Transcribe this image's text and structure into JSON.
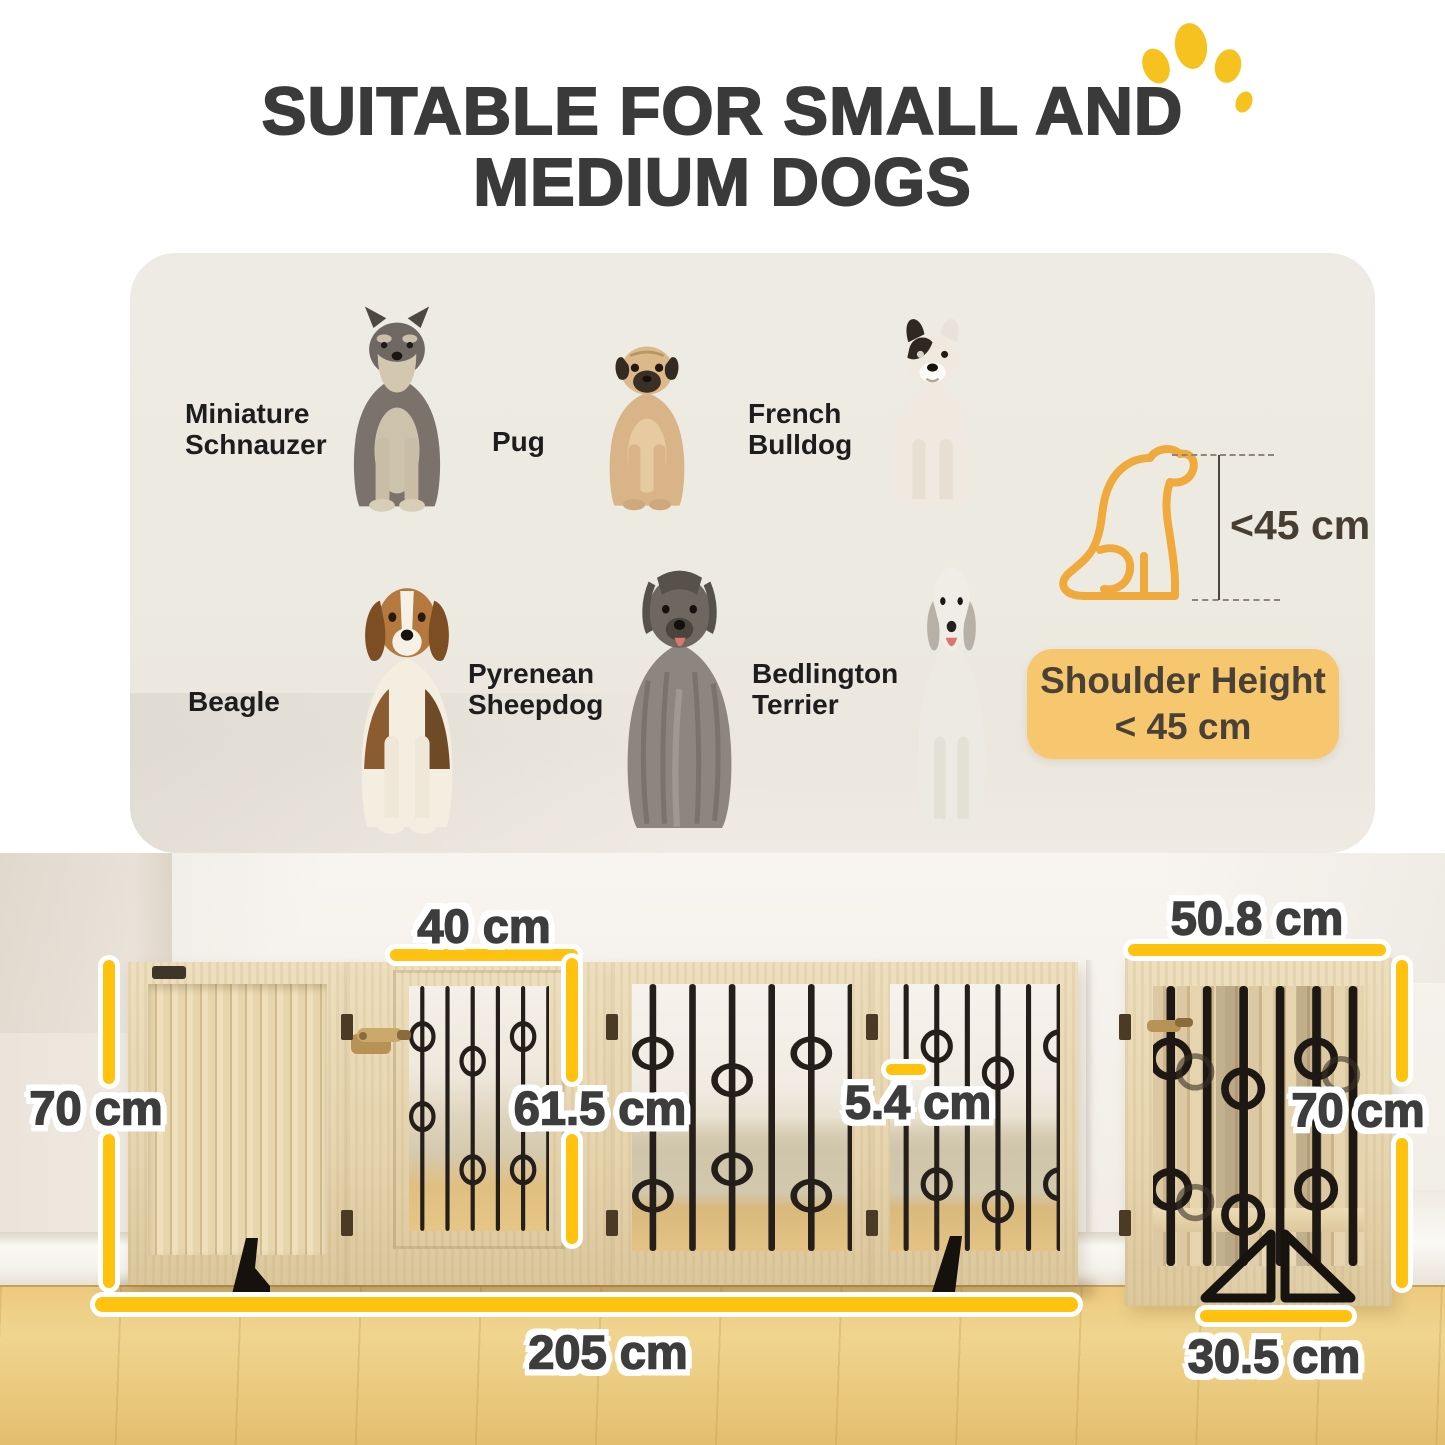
{
  "title": {
    "line1": "SUITABLE FOR SMALL AND",
    "line2": "MEDIUM DOGS"
  },
  "breeds": [
    {
      "name": "Miniature Schnauzer"
    },
    {
      "name": "Pug"
    },
    {
      "name": "French Bulldog"
    },
    {
      "name": "Beagle"
    },
    {
      "name": "Pyrenean Sheepdog"
    },
    {
      "name": "Bedlington Terrier"
    }
  ],
  "height_rule": {
    "icon_label": "<45 cm",
    "badge_line1": "Shoulder Height",
    "badge_line2": "< 45 cm"
  },
  "dimensions": {
    "door_width": "40 cm",
    "single_panel_width": "50.8 cm",
    "height_left": "70 cm",
    "door_height": "61.5 cm",
    "bar_gap": "5.4 cm",
    "height_right": "70 cm",
    "total_width": "205 cm",
    "support_foot_depth": "30.5 cm"
  },
  "colors": {
    "accent_yellow": "#FFC20E",
    "badge_bg": "#F6C76F",
    "dog_outline_orange": "#F0A93C",
    "paw_yellow": "#F5C21F",
    "title_text": "#3A3A3A",
    "panel_bg": "#EDEAE2"
  }
}
